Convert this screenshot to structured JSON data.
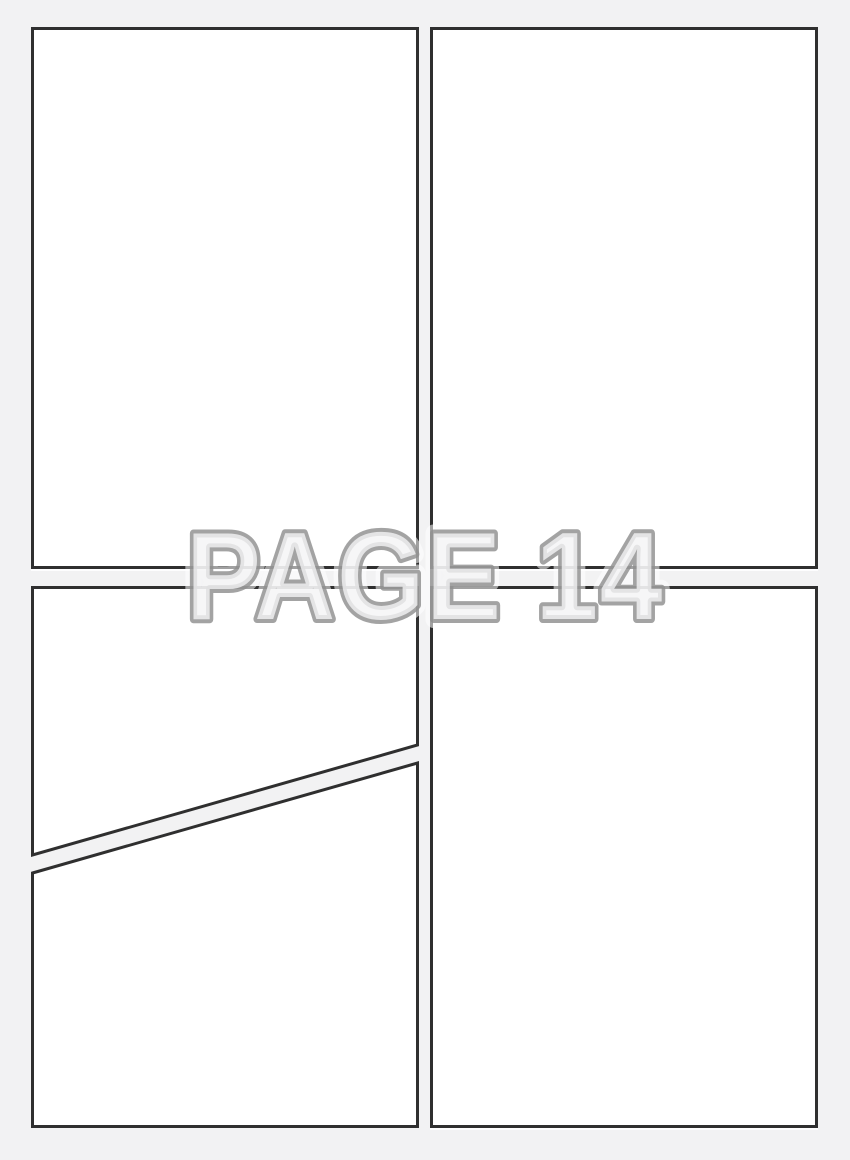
{
  "page": {
    "label": "PAGE 14"
  },
  "colors": {
    "background": "#f2f2f3",
    "panel_fill": "#ffffff",
    "panel_border": "#2f2f2f",
    "label_fill": "#f4f4f5",
    "label_outline": "#8f8f8f"
  },
  "panels": [
    {
      "name": "panel-top-left"
    },
    {
      "name": "panel-top-right"
    },
    {
      "name": "panel-bottom-left-upper"
    },
    {
      "name": "panel-bottom-left-lower"
    },
    {
      "name": "panel-bottom-right"
    }
  ]
}
